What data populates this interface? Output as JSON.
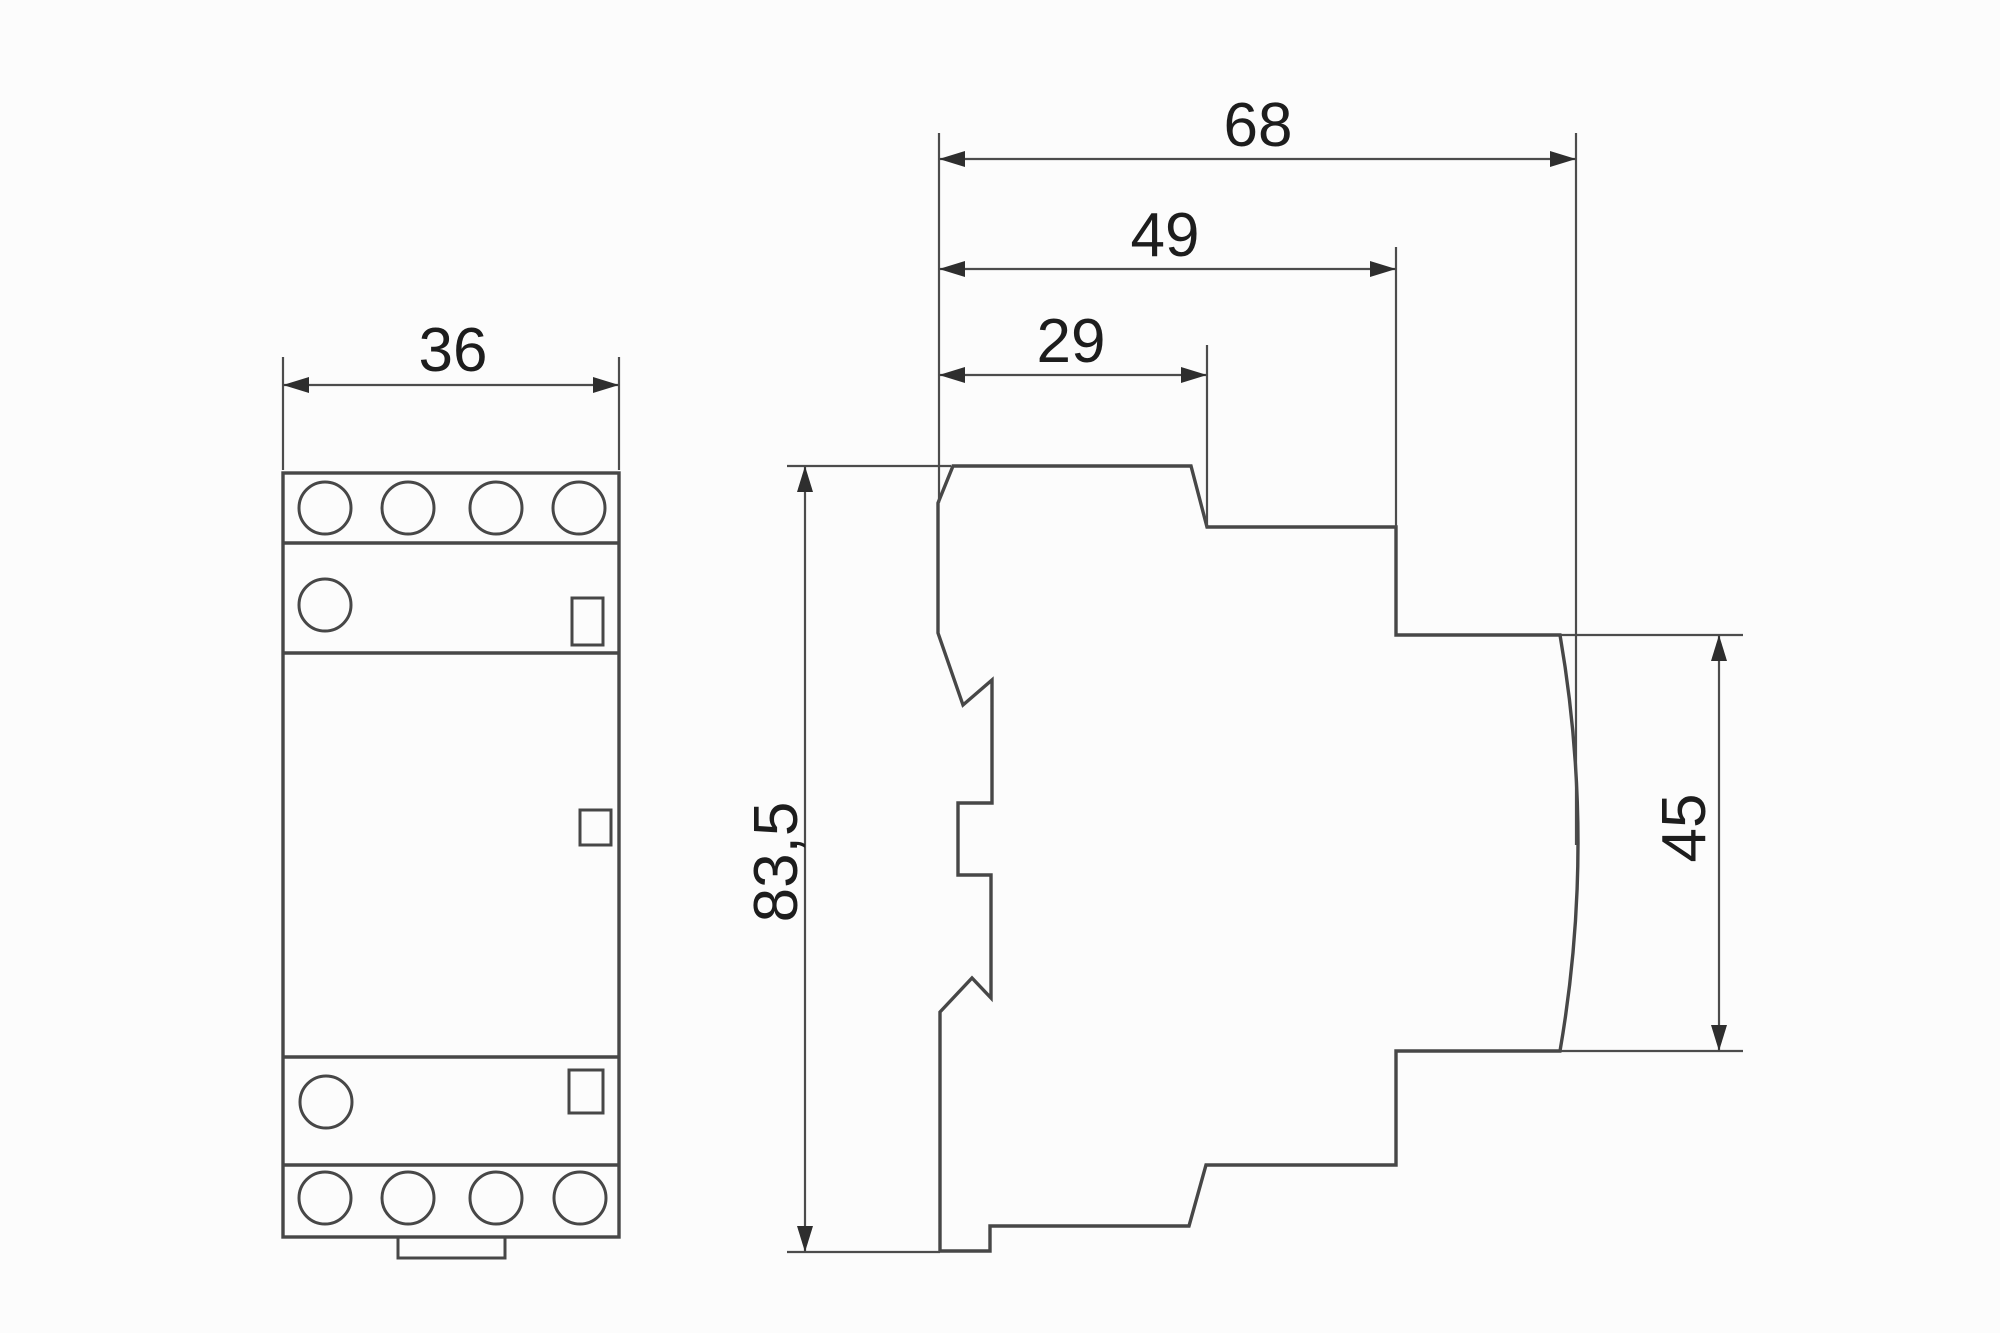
{
  "drawing": {
    "kind": "technical dimension drawing, modular DIN-rail contactor, front and side views",
    "background_color": "#fcfcfc",
    "line_color": "#474747",
    "text_color": "#1d1d1d"
  },
  "dims": {
    "front_width": "36",
    "total_depth": "68",
    "mid_depth": "49",
    "top_depth": "29",
    "height": "83,5",
    "front_face_height": "45"
  }
}
